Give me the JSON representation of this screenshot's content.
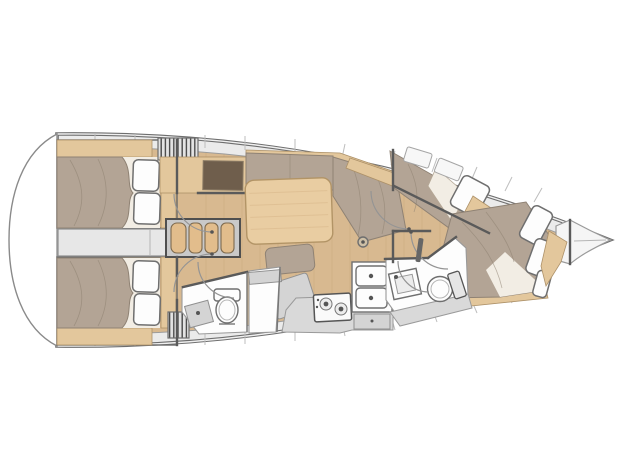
{
  "meta": {
    "title": "Sailboat interior deck plan",
    "view": "top-down floor plan, bow pointing right"
  },
  "colors": {
    "bg": "#ffffff",
    "hullOutline": "#6e6e6e",
    "hullCore": "#f0f0f0",
    "deck": "#ebebeb",
    "deckLine": "#bdbdbd",
    "innerHullLine": "#9c9c9c",
    "floorWood": "#d8b990",
    "furnitureWood": "#e3c79c",
    "woodEdge": "#ad9168",
    "stepWood": "#e2bd8c",
    "tableWood": "#e9cda2",
    "navDesk": "#6f5e4c",
    "cushion": "#b3a495",
    "cushionEdge": "#8f8274",
    "sheet": "#f2ede4",
    "fixtureWhite": "#fdfdfd",
    "fixtureStroke": "#6f6f6f",
    "grayUnit": "#d4d4d4",
    "grayCounter": "#d9d9d9",
    "engineBay": "#e7e7e7",
    "wall": "#5a5a5a",
    "grainLine": "#b98f5f"
  },
  "legend": {
    "areas": [
      "aft-cabin-top",
      "aft-cabin-bottom",
      "engine-compartment",
      "companionway-steps",
      "nav-station",
      "saloon",
      "galley",
      "aft-head",
      "shower",
      "forward-cabin-side",
      "forward-cabin-bow",
      "forward-head",
      "anchor-locker"
    ],
    "fixtures": [
      "double-berth",
      "pillow",
      "saloon-table",
      "settee-cushions",
      "chart-table",
      "two-burner-stove",
      "double-sink",
      "toilet",
      "washbasin",
      "compression-post",
      "door-swing-arc",
      "deck-hatch"
    ]
  }
}
